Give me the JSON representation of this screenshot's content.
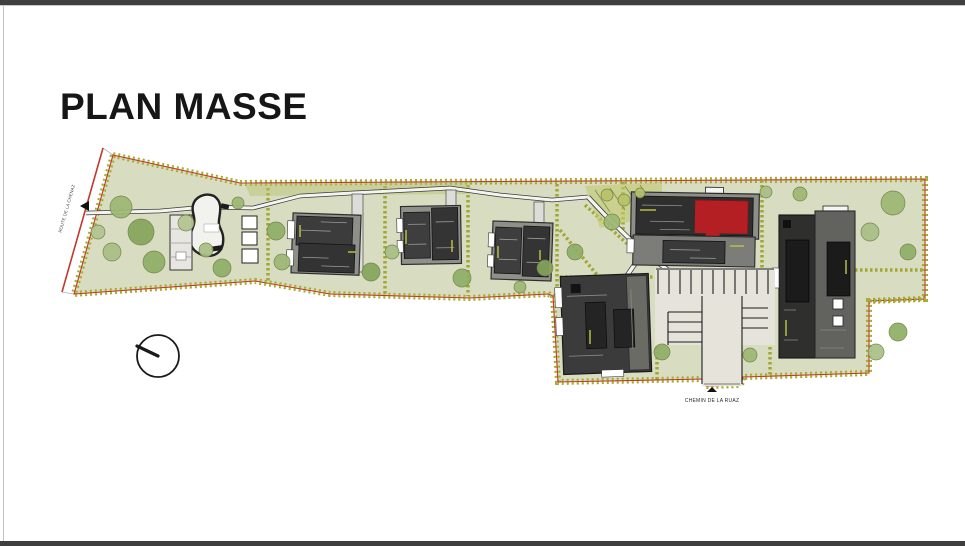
{
  "page": {
    "title": "PLAN MASSE"
  },
  "plan": {
    "road_label": "ROUTE DE LA CHENAZ",
    "street_label": "CHEMIN DE LA RUAZ",
    "icons": {
      "north_compass": "circle-with-needle",
      "road_arrow": "small-black-triangle",
      "street_marker": "small-black-triangle"
    },
    "palette": {
      "terrain": "#d8dcc1",
      "hedge_olive": "#a2a733",
      "hedge_yellow": "#c2c64d",
      "boundary_red": "#c0392b",
      "building_dark": "#343434",
      "building_mid": "#6b6b66",
      "building_light": "#8f8f8a",
      "roof_red": "#b41f24",
      "path_white": "#f4f4f0",
      "parking_gravel": "#e6e3da",
      "tree_greens": [
        "#9db873",
        "#85a55c",
        "#a9bf85",
        "#8fae66",
        "#b9c26a"
      ],
      "window_chrome": "#3f3f3f"
    }
  }
}
